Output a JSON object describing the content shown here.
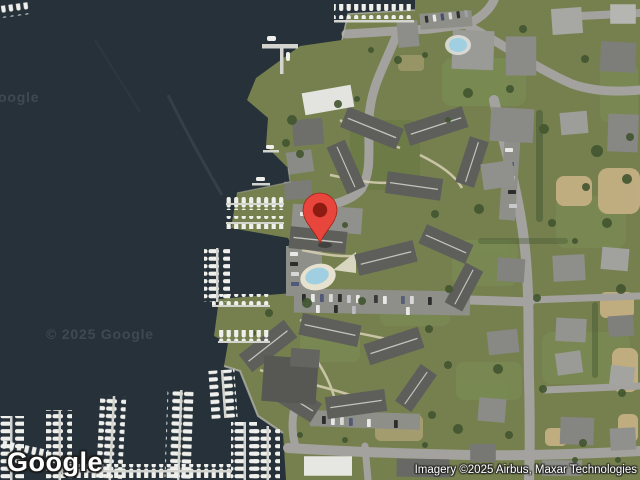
{
  "map": {
    "view": "satellite",
    "provider_logo": "Google",
    "attribution": "Imagery ©2025 Airbus, Maxar Technologies",
    "watermarks": {
      "center": "© 2025 Google",
      "left_edge": "oogle"
    },
    "marker": {
      "description": "red location pin",
      "tip_x": 320,
      "tip_y": 243
    }
  },
  "colors": {
    "water": "#263139",
    "grass": "#76804f",
    "grass_light": "#7c9055",
    "road": "#a3a29e",
    "roof": "#5e5e5b",
    "dock": "#d4d4ce",
    "boat": "#efefeb",
    "sand": "#c7b286",
    "tree": "#41552f",
    "pin_outer": "#e8453c",
    "pin_inner": "#8e1b12",
    "pool": "#9fcfe0"
  }
}
